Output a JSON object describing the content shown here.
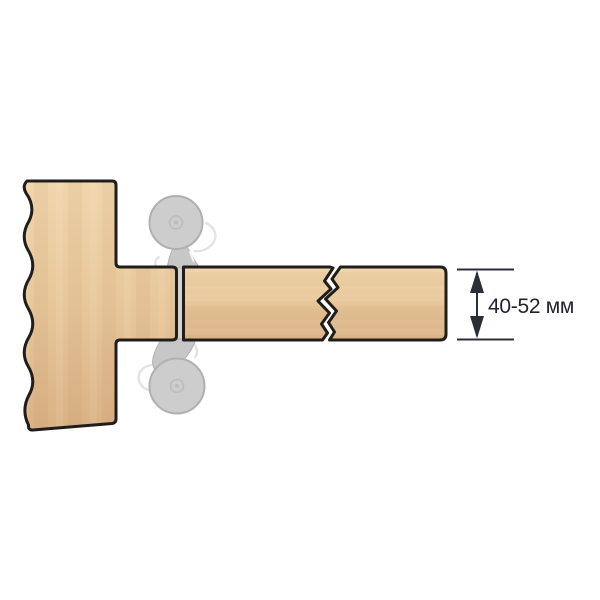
{
  "diagram": {
    "dimension_label": "40-52 мм"
  },
  "colors": {
    "background": "#ffffff",
    "wood_light": "#f0d6ac",
    "wood_mid": "#e7c79a",
    "wood_dark": "#d9b184",
    "outline": "#201d1a",
    "cutter_fill": "#cdcdcd",
    "cutter_stroke": "#b0b0b0",
    "stem_fill": "#c7c7c7",
    "spindle_fill": "#d3d3d3",
    "hub_stroke": "#bcbcbc",
    "ghost_stroke": "#e3e3e3",
    "dimension": "#2a2e37",
    "label_text": "#20242c"
  }
}
